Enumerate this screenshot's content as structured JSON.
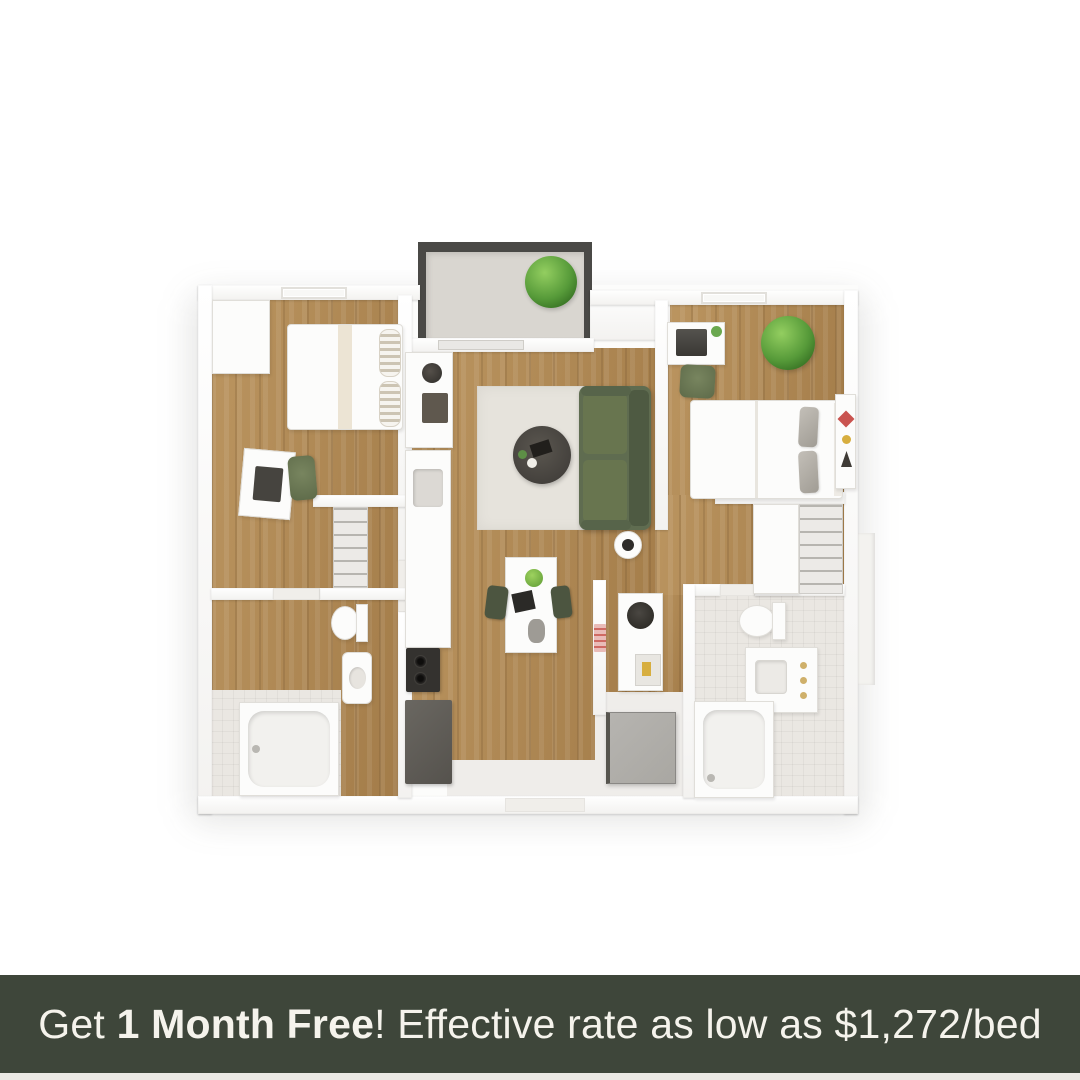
{
  "banner": {
    "text_prefix": "Get ",
    "text_highlight": "1 Month Free",
    "text_suffix": "! Effective rate as low as $1,272/bed"
  },
  "palette": {
    "banner_bg": "#3e463a",
    "banner_text": "#f5f3ec",
    "wood": "#b28c5c",
    "tile": "#eae7e2",
    "balcony_rail": "#4a4946",
    "balcony_floor": "#d9d6d0",
    "sofa": "#5f6c50",
    "sofa_dark": "#4e5a42",
    "rug": "#e6e3dc",
    "chair_green": "#5d6a49",
    "appliance_dark": "#34322f",
    "fridge": "#55524d",
    "washer": "#a9a7a2",
    "accent_red": "#c9534f",
    "accent_yellow": "#d7ae3f"
  },
  "floor_plan": {
    "description": "3D top-down rendering of a 2-bedroom, 2-bathroom apartment floor plan with balcony, living room, dining area, kitchen, closets and laundry",
    "rooms": [
      "balcony",
      "bedroom-left",
      "bedroom-right",
      "living-room",
      "dining-area",
      "kitchen",
      "bathroom-left",
      "bathroom-right",
      "closet-left",
      "closet-right",
      "tech-nook",
      "laundry",
      "entry"
    ]
  }
}
